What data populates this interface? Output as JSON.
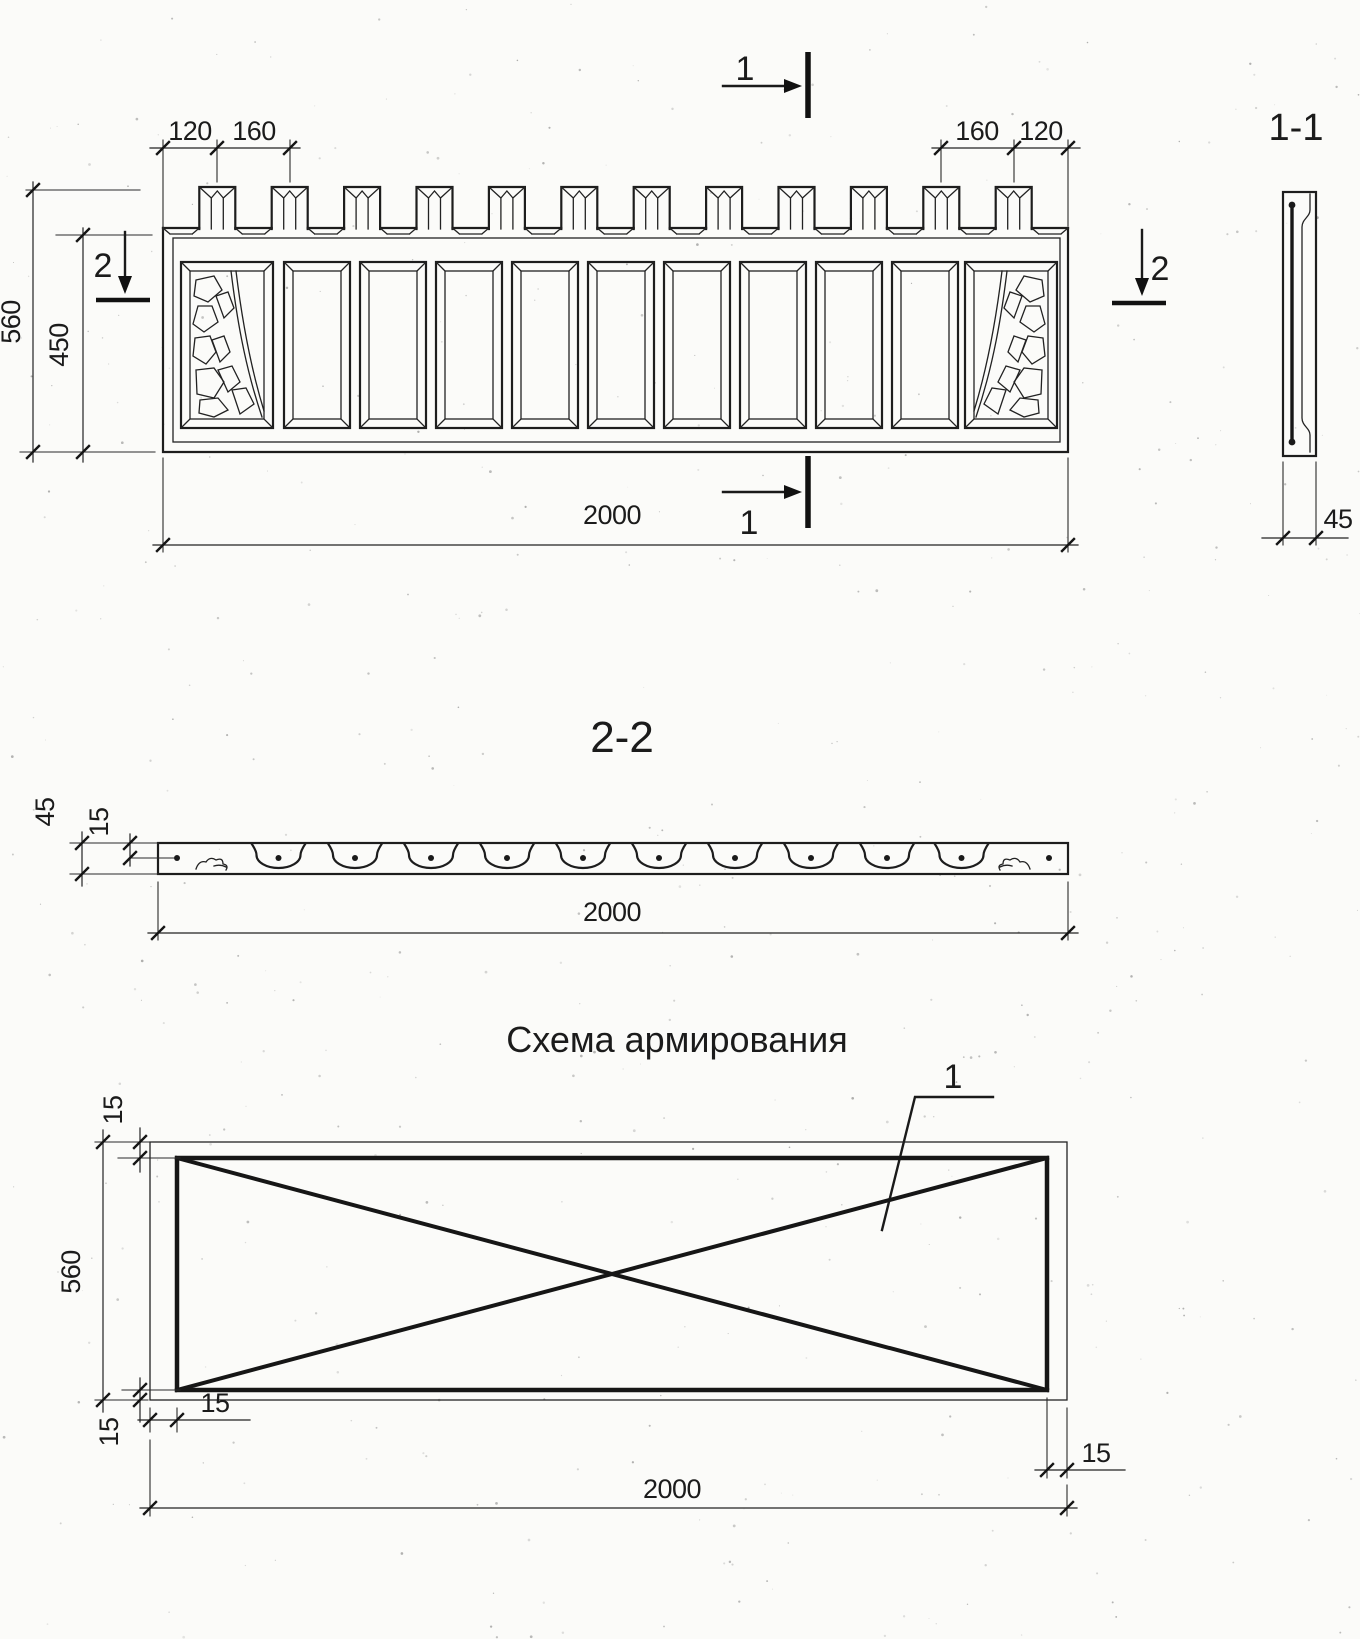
{
  "sheet_title": "Fence panel working drawing",
  "colors": {
    "ink": "#1d1d1d",
    "paper": "#fbfbf9"
  },
  "elevation": {
    "dim_left_a": "120",
    "dim_left_b": "160",
    "dim_right_a": "160",
    "dim_right_b": "120",
    "dim_height": "560",
    "dim_body_height": "450",
    "dim_width": "2000",
    "mark_1": "1",
    "mark_2": "2"
  },
  "section11": {
    "title": "1-1",
    "dim_thickness": "45"
  },
  "section22": {
    "title": "2-2",
    "dim_thickness": "45",
    "dim_cover": "15",
    "dim_width": "2000"
  },
  "scheme": {
    "title": "Схема армирования",
    "bar_label": "1",
    "dim_top": "15",
    "dim_height": "560",
    "dim_bottom": "15",
    "dim_left": "15",
    "dim_right": "15",
    "dim_width": "2000"
  },
  "geometry": {
    "merlon_count": 12,
    "opening_count": 11,
    "rib_sections": 10
  }
}
